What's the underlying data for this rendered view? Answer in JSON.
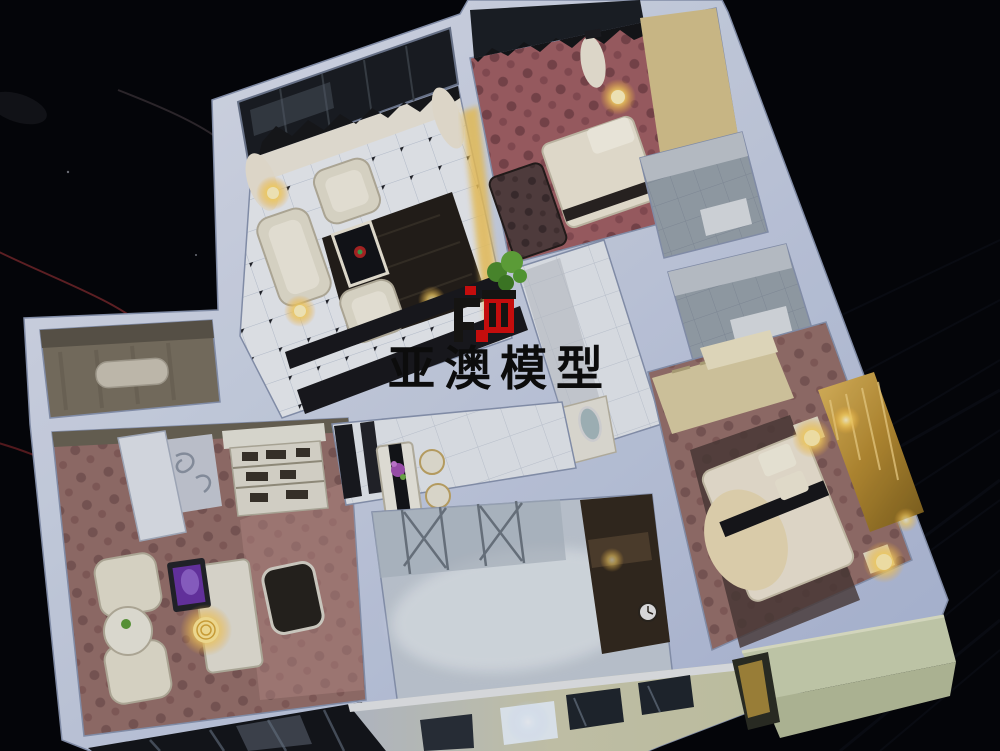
{
  "photo": {
    "type": "photograph",
    "subject": "miniature-apartment-interior-scale-model",
    "viewpoint": "high-oblique-overhead",
    "background": "black-ribbed-tablecloth-with-red-wires"
  },
  "watermark": {
    "text": "亚澳模型",
    "logo_name": "ya-ao-model-logo",
    "logo_colors": {
      "black": "#151412",
      "red": "#c40d0d"
    }
  },
  "scene": {
    "rooms": [
      "balcony-top",
      "living-room",
      "bedroom-top-right",
      "hallway",
      "bathroom-1",
      "bathroom-2",
      "master-bedroom",
      "side-room-left",
      "study-room",
      "dining-area",
      "kitchen",
      "entry-foyer",
      "street-facade",
      "balcony-box-bottom-right"
    ],
    "lighting": [
      "warm-led-lamps",
      "glowing-laptop-screen",
      "lit-facade-window"
    ],
    "palette": {
      "table_black": "#05060a",
      "wall_light": "#dde3f1",
      "wall_shade": "#b4c0da",
      "marble_floor": "#edf0f6",
      "rose_carpet": "#a26167",
      "mauve_carpet": "#97716d",
      "grey_tile": "#99a3ad",
      "gold_panel": "#c49a3f",
      "warm_glow": "#ffe9a8",
      "laptop_purple": "#6a35a8",
      "facade_cream": "#cfceb2",
      "wire_red": "#82282c"
    }
  }
}
